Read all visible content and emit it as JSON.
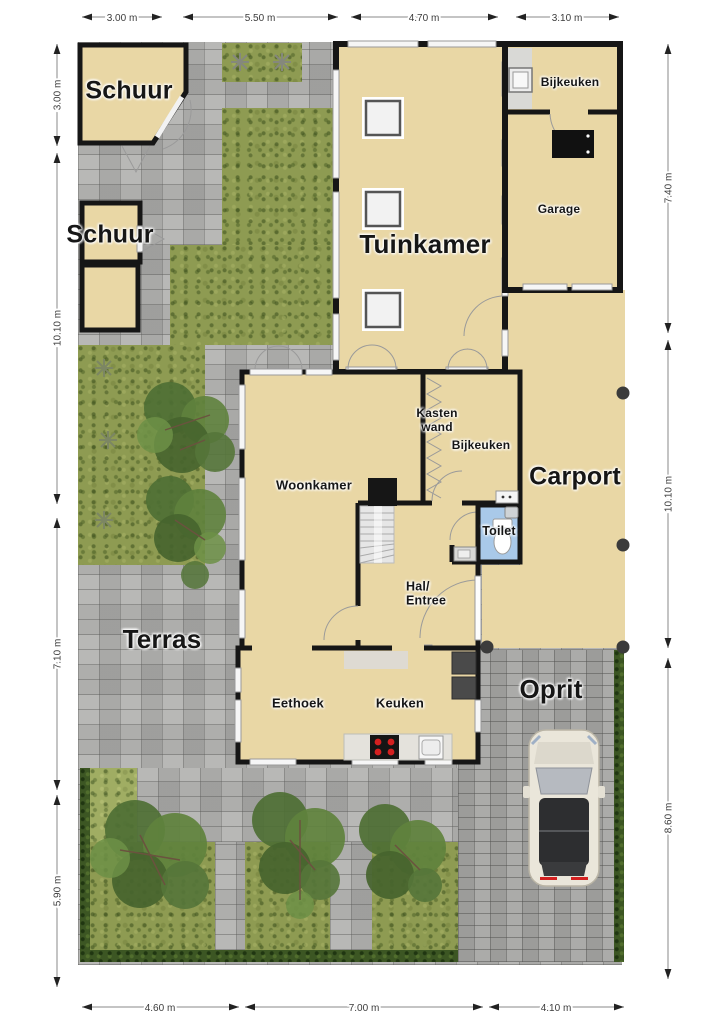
{
  "plan": {
    "type": "floorplan-top-view",
    "unit": "m"
  },
  "rooms": {
    "schuur_top": {
      "label": "Schuur"
    },
    "schuur_left": {
      "label": "Schuur"
    },
    "tuinkamer": {
      "label": "Tuinkamer"
    },
    "bijkeuken_top": {
      "label": "Bijkeuken"
    },
    "garage": {
      "label": "Garage"
    },
    "carport": {
      "label": "Carport"
    },
    "woonkamer": {
      "label": "Woonkamer"
    },
    "kasten_wand": {
      "label": "Kasten\nwand"
    },
    "bijkeuken_mid": {
      "label": "Bijkeuken"
    },
    "toilet": {
      "label": "Toilet"
    },
    "hal": {
      "label": "Hal/\nEntree"
    },
    "eethoek": {
      "label": "Eethoek"
    },
    "keuken": {
      "label": "Keuken"
    }
  },
  "outdoor": {
    "terras": {
      "label": "Terras"
    },
    "oprit": {
      "label": "Oprit"
    }
  },
  "dimensions": {
    "top": [
      {
        "label": "3.00 m"
      },
      {
        "label": "5.50 m"
      },
      {
        "label": "4.70 m"
      },
      {
        "label": "3.10 m"
      }
    ],
    "bottom": [
      {
        "label": "4.60 m"
      },
      {
        "label": "7.00 m"
      },
      {
        "label": "4.10 m"
      }
    ],
    "left": [
      {
        "label": "3.00 m"
      },
      {
        "label": "10.10 m"
      },
      {
        "label": "7.10 m"
      },
      {
        "label": "5.90 m"
      }
    ],
    "right": [
      {
        "label": "7.40 m"
      },
      {
        "label": "10.10 m"
      },
      {
        "label": "8.60 m"
      }
    ]
  },
  "colors": {
    "room_fill": "#e9d7a5",
    "wall": "#161616",
    "paving": "#aeaeac",
    "grass": "#8e9b52",
    "hedge": "#3c5623",
    "toilet_floor": "#a9c9e9",
    "burner_red": "#d42020",
    "car_body": "#eae6da",
    "car_roof": "#2d2e30"
  }
}
